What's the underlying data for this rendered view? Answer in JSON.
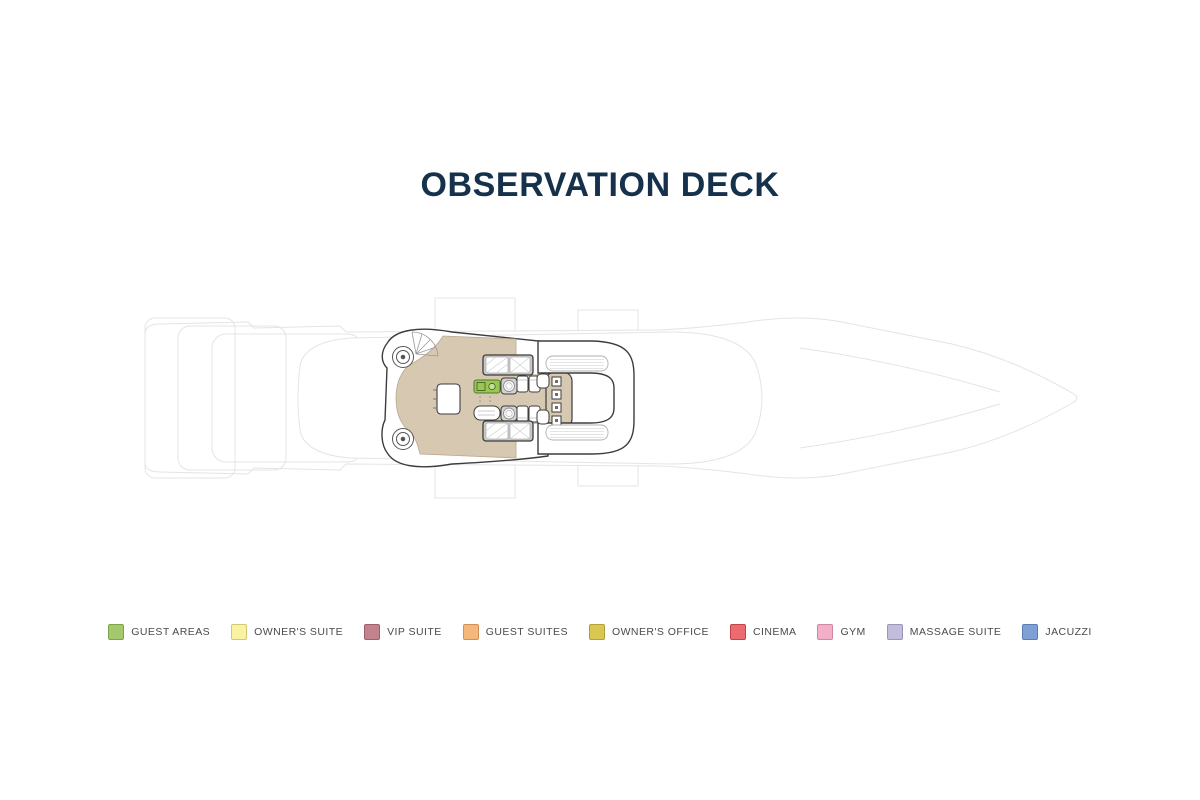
{
  "header": {
    "title": "OBSERVATION DECK",
    "title_color": "#15314b"
  },
  "plan": {
    "name": "yacht-observation-deck-plan",
    "colors": {
      "accent_green": "#9cc653",
      "deck_floor": "#d7c8b2",
      "structure_line": "#3d3d3d",
      "hull_faint_line": "#e4e4e4",
      "sunpad_gray": "#c9c9c9"
    }
  },
  "legend": {
    "label_color": "#4a4a4a",
    "items": [
      {
        "label": "GUEST AREAS",
        "fill": "#a5c76b",
        "border": "#7fa34c"
      },
      {
        "label": "OWNER'S SUITE",
        "fill": "#f8f3a0",
        "border": "#cfc878"
      },
      {
        "label": "VIP SUITE",
        "fill": "#c2838f",
        "border": "#a05f6c"
      },
      {
        "label": "GUEST SUITES",
        "fill": "#f6b77b",
        "border": "#d19055"
      },
      {
        "label": "OWNER'S OFFICE",
        "fill": "#d9c752",
        "border": "#b3a238"
      },
      {
        "label": "CINEMA",
        "fill": "#ed6a70",
        "border": "#c24349"
      },
      {
        "label": "GYM",
        "fill": "#f3aec8",
        "border": "#cf87a5"
      },
      {
        "label": "MASSAGE SUITE",
        "fill": "#c1bddb",
        "border": "#9a95bd"
      },
      {
        "label": "JACUZZI",
        "fill": "#7da0d5",
        "border": "#5a7fb5"
      }
    ]
  }
}
